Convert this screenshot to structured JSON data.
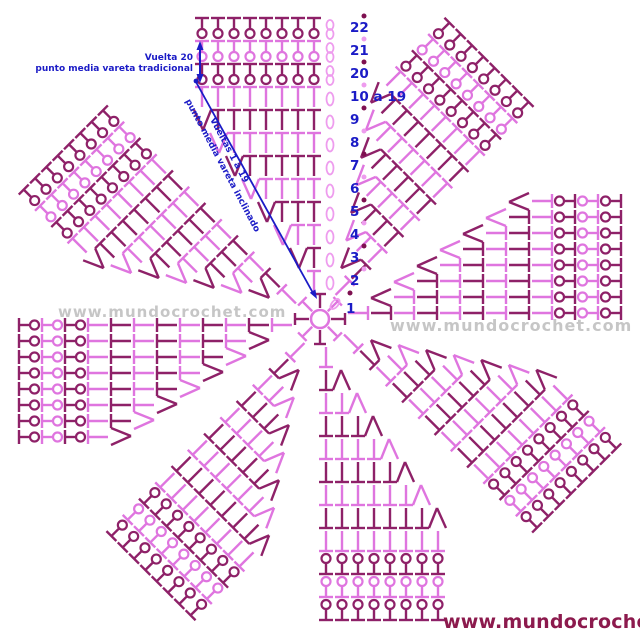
{
  "colors": {
    "light": "#DF75DF",
    "light_soft": "#EE9CEE",
    "dark": "#8E2168",
    "dark_dot": "#7E1050",
    "blue": "#1B1BC6",
    "footer_maroon": "#8C1A4D",
    "watermark_gray": "#8F8F8F"
  },
  "annotations": {
    "vuelta20": {
      "line1": "Vuelta 20",
      "line2": "punto media vareta tradicional"
    },
    "vueltas1a19": {
      "line1": "Vueltas 1 a 19",
      "line2": "punto media vareta inclinado"
    }
  },
  "watermark": {
    "left": "www.mundocrochet.com",
    "right": "www.mundocrochet.com"
  },
  "footer": {
    "url": "www.mundocrochet.com"
  },
  "diagram": {
    "center": {
      "x": 320,
      "y": 319,
      "ring_radius": 9
    },
    "petal_count": 8,
    "angle_step": 45,
    "stitch_spacing": 16,
    "stem_length": 20,
    "crossbar_half": 7,
    "row_start": 28,
    "row_spacing": 23,
    "round1_label": "1",
    "rows": [
      {
        "label": "2",
        "stitches": 1,
        "v": false,
        "chains": 1,
        "curl": false,
        "shade": "light"
      },
      {
        "label": "3",
        "stitches": 2,
        "v": true,
        "chains": 1,
        "curl": false,
        "shade": "dark"
      },
      {
        "label": "4",
        "stitches": 3,
        "v": true,
        "chains": 1,
        "curl": false,
        "shade": "light"
      },
      {
        "label": "5",
        "stitches": 4,
        "v": true,
        "chains": 1,
        "curl": false,
        "shade": "dark"
      },
      {
        "label": "6",
        "stitches": 5,
        "v": true,
        "chains": 1,
        "curl": false,
        "shade": "light"
      },
      {
        "label": "7",
        "stitches": 6,
        "v": true,
        "chains": 1,
        "curl": false,
        "shade": "dark"
      },
      {
        "label": "8",
        "stitches": 7,
        "v": true,
        "chains": 1,
        "curl": false,
        "shade": "light"
      },
      {
        "label": "9",
        "stitches": 8,
        "v": true,
        "chains": 1,
        "curl": false,
        "shade": "dark"
      },
      {
        "label": "10 a 19",
        "stitches": 8,
        "v": false,
        "chains": 1,
        "curl": false,
        "shade": "light"
      },
      {
        "label": "20",
        "stitches": 8,
        "v": false,
        "chains": 2,
        "curl": true,
        "shade": "dark"
      },
      {
        "label": "21",
        "stitches": 8,
        "v": false,
        "chains": 2,
        "curl": true,
        "shade": "light"
      },
      {
        "label": "22",
        "stitches": 8,
        "v": false,
        "chains": 2,
        "curl": true,
        "shade": "dark"
      }
    ]
  }
}
